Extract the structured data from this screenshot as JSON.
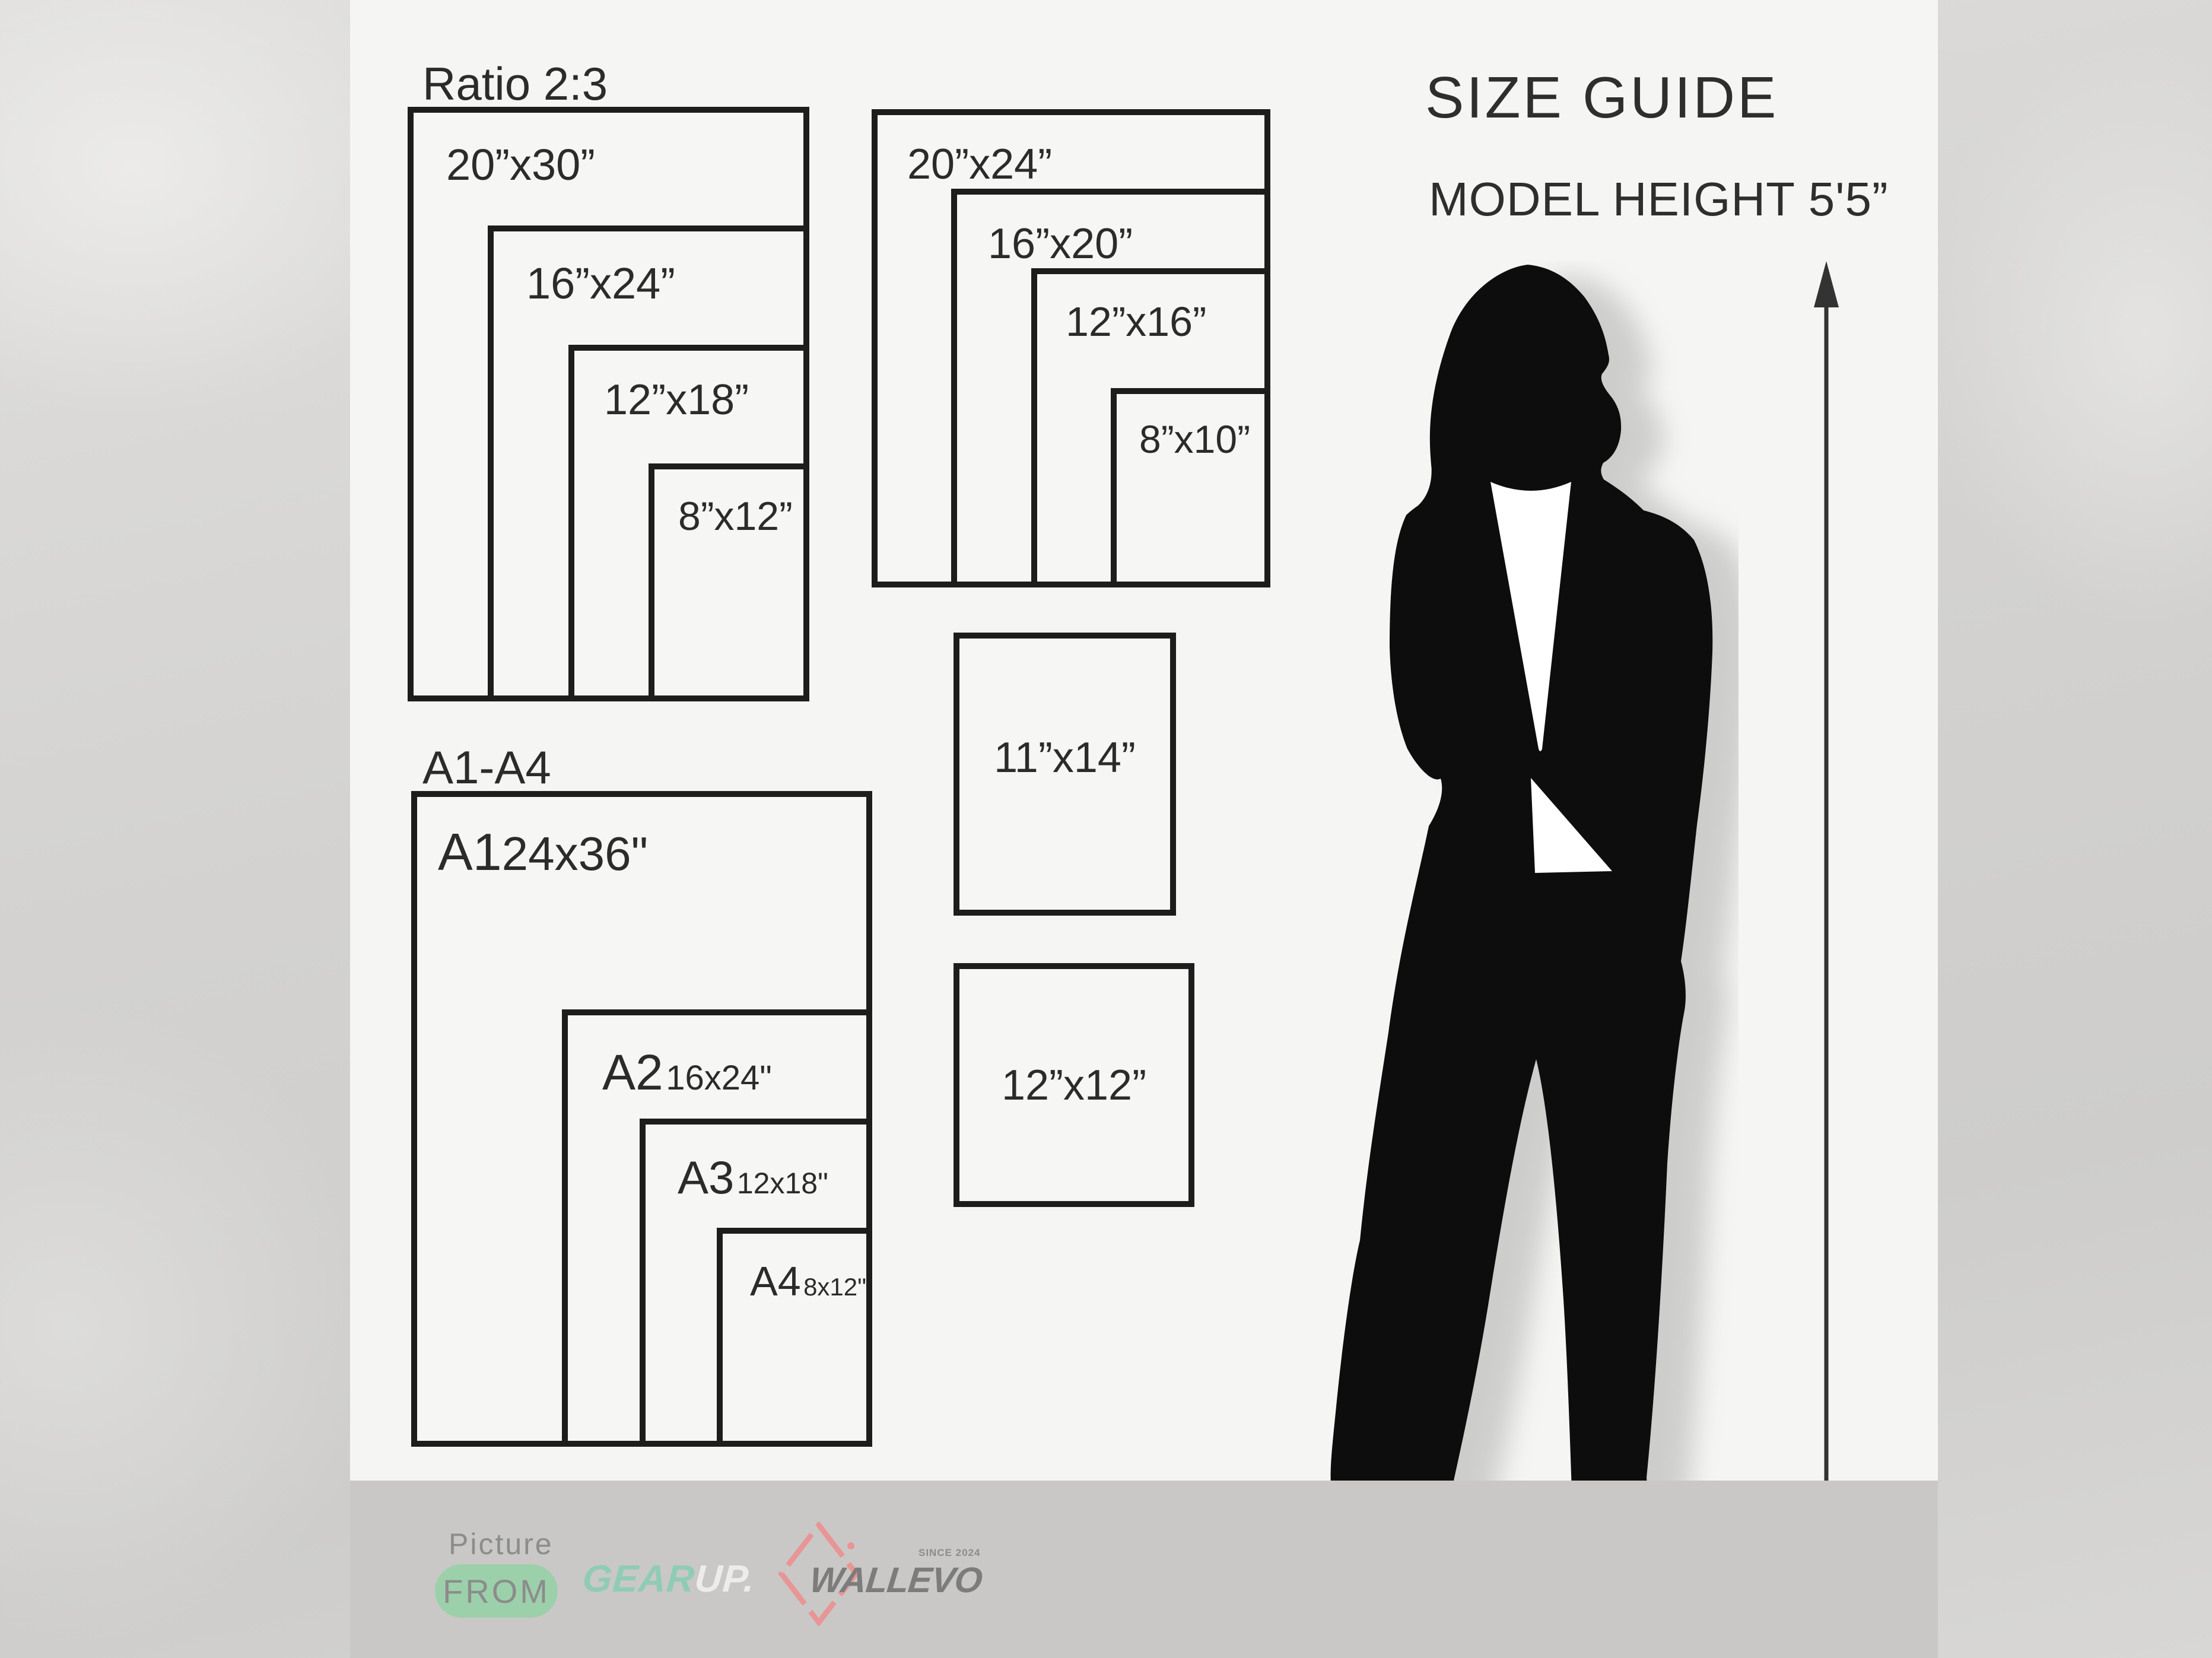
{
  "header": {
    "title": "SIZE GUIDE",
    "model_height": "MODEL HEIGHT 5'5”"
  },
  "ratio_group": {
    "heading": "Ratio 2:3",
    "sizes": [
      "20”x30”",
      "16”x24”",
      "12”x18”",
      "8”x12”"
    ]
  },
  "standard_group": {
    "sizes": [
      "20”x24”",
      "16”x20”",
      "12”x16”",
      "8”x10”"
    ]
  },
  "single_boxes": {
    "box1": "11”x14”",
    "box2": "12”x12”"
  },
  "a_series": {
    "heading": "A1-A4",
    "items": [
      {
        "code": "A1",
        "size": "24x36\""
      },
      {
        "code": "A2",
        "size": "16x24\""
      },
      {
        "code": "A3",
        "size": "12x18\""
      },
      {
        "code": "A4",
        "size": "8x12\""
      }
    ]
  },
  "footer": {
    "picture_label": "Picture",
    "from_label": "FROM",
    "gearup": {
      "gear": "GEAR",
      "up": "UP."
    },
    "wallevo": {
      "name": "WALLEVO",
      "since": "SINCE 2024"
    }
  },
  "colors": {
    "ink": "#1d1d1d",
    "label": "#2b2b2b",
    "content_bg": "#f5f5f3",
    "footer_bg": "#c9c8c6",
    "pill_green": "#9cd0aa",
    "gear_teal": "#8fccb7",
    "up_white": "#ececec",
    "logo_gray": "#7c7c7c",
    "diamond_red": "#e89595",
    "muted_gray": "#8c8c8c"
  }
}
